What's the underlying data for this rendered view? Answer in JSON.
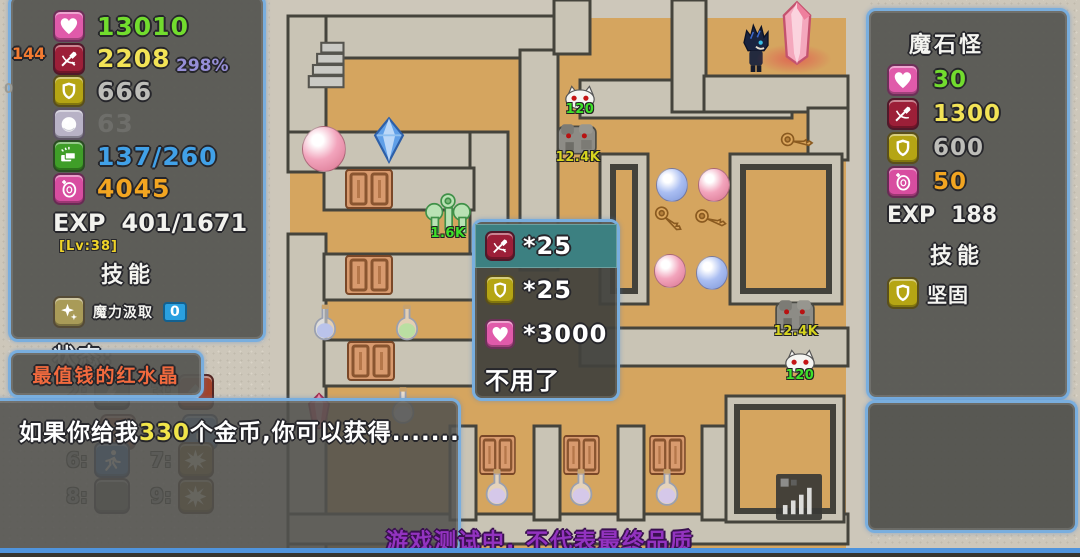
{
  "colors": {
    "panel_border": "#79aede",
    "panel_bg": "#585854",
    "hp_green": "#72dc2e",
    "atk_yellow": "#f2e356",
    "def_gray": "#bdbdb9",
    "gold_blue": "#41a1e8",
    "coin_orange": "#f2a521",
    "buff_orange": "#f37b31",
    "crit_purple": "#968ed6",
    "nameplate_orange": "#f26a3e",
    "notice_purple": "#9333c0",
    "menu_highlight_teal": "#3c8081",
    "map_floor_tan": "#d5a55f",
    "map_wall_stone": "#c9c4b5"
  },
  "player_panel": {
    "stats": [
      {
        "name": "hp",
        "icon": "heart-icon",
        "value": "13010"
      },
      {
        "name": "attack",
        "icon": "sword-icon",
        "value": "2208",
        "left_note": "144",
        "right_note": "298%"
      },
      {
        "name": "defense",
        "icon": "shield-icon",
        "value": "666",
        "left_note": "0"
      },
      {
        "name": "orb",
        "icon": "orb-icon",
        "value": "63"
      },
      {
        "name": "gold-pickup",
        "icon": "money-icon",
        "value": "137/260"
      },
      {
        "name": "coin",
        "icon": "coin-icon",
        "value": "4045"
      }
    ],
    "exp_label": "EXP",
    "exp_value": "401/1671",
    "level": "[Lv:38]",
    "skills_title": "技能",
    "skill": {
      "name": "魔力汲取",
      "count": "0"
    },
    "status_label": "状态:"
  },
  "hotkey_bar": {
    "slots": [
      {
        "key": "2:",
        "icon": "lightning-icon"
      },
      {
        "key": "3:",
        "icon": "arrow-up-icon"
      },
      {
        "key": "6:",
        "icon": "runner-icon"
      },
      {
        "key": "7:",
        "icon": "burst-icon"
      },
      {
        "key": "8:",
        "icon": "empty-slot"
      },
      {
        "key": "9:",
        "icon": "burst-icon"
      }
    ]
  },
  "npc": {
    "name": "最值钱的红水晶"
  },
  "dialog": {
    "text_before": "如果你给我",
    "amount": "330",
    "text_after": "个金币,你可以获得......."
  },
  "choice_menu": {
    "selected_index": 0,
    "options": [
      {
        "icon": "sword-icon",
        "label": "*25"
      },
      {
        "icon": "shield-icon",
        "label": "*25"
      },
      {
        "icon": "heart-icon",
        "label": "*3000"
      },
      {
        "icon": "",
        "label": "不用了"
      }
    ]
  },
  "monster_panel": {
    "name": "魔石怪",
    "stats": [
      {
        "name": "hp",
        "icon": "heart-icon",
        "value": "30"
      },
      {
        "name": "attack",
        "icon": "sword-icon",
        "value": "1300"
      },
      {
        "name": "defense",
        "icon": "shield-icon",
        "value": "600"
      },
      {
        "name": "coin",
        "icon": "coin-icon",
        "value": "50"
      }
    ],
    "exp_label": "EXP",
    "exp_value": "188",
    "skills_title": "技能",
    "skill_name": "坚固"
  },
  "map": {
    "labels": {
      "bat_top": "120",
      "golem_top": "12.4K",
      "key_monster": "1.6K",
      "golem_bottom": "12.4K",
      "bat_bottom": "120"
    }
  },
  "window": {
    "footer_notice": "游戏测试中, 不代表最终品质"
  }
}
